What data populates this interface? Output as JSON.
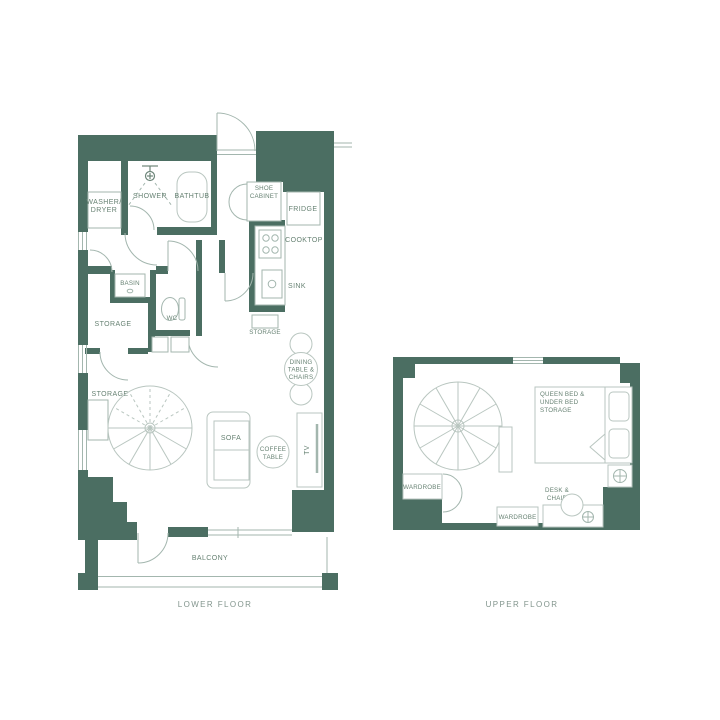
{
  "palette": {
    "wall": "#4b6e62",
    "line": "#b9c6c0",
    "line2": "#a3b6ae",
    "label": "#678273",
    "title": "#82958d"
  },
  "titles": {
    "lower": "LOWER FLOOR",
    "upper": "UPPER FLOOR"
  },
  "lower": {
    "washer_dryer": [
      "WASHER/",
      "DRYER"
    ],
    "shower": "SHOWER",
    "bathtub": "BATHTUB",
    "shoe_cabinet": [
      "SHOE",
      "CABINET"
    ],
    "fridge": "FRIDGE",
    "cooktop": "COOKTOP",
    "sink": "SINK",
    "basin": "BASIN",
    "wc": "WC",
    "storage_hall": "STORAGE",
    "storage_kitchen": "STORAGE",
    "storage_living": "STORAGE",
    "dining": [
      "DINING",
      "TABLE &",
      "CHAIRS"
    ],
    "sofa": "SOFA",
    "coffee_table": [
      "COFFEE",
      "TABLE"
    ],
    "tv": "TV",
    "balcony": "BALCONY"
  },
  "upper": {
    "queen_bed": [
      "QUEEN BED &",
      "UNDER BED",
      "STORAGE"
    ],
    "wardrobe_left": "WARDROBE",
    "wardrobe_bottom": "WARDROBE",
    "desk_chair": [
      "DESK &",
      "CHAIR"
    ]
  }
}
